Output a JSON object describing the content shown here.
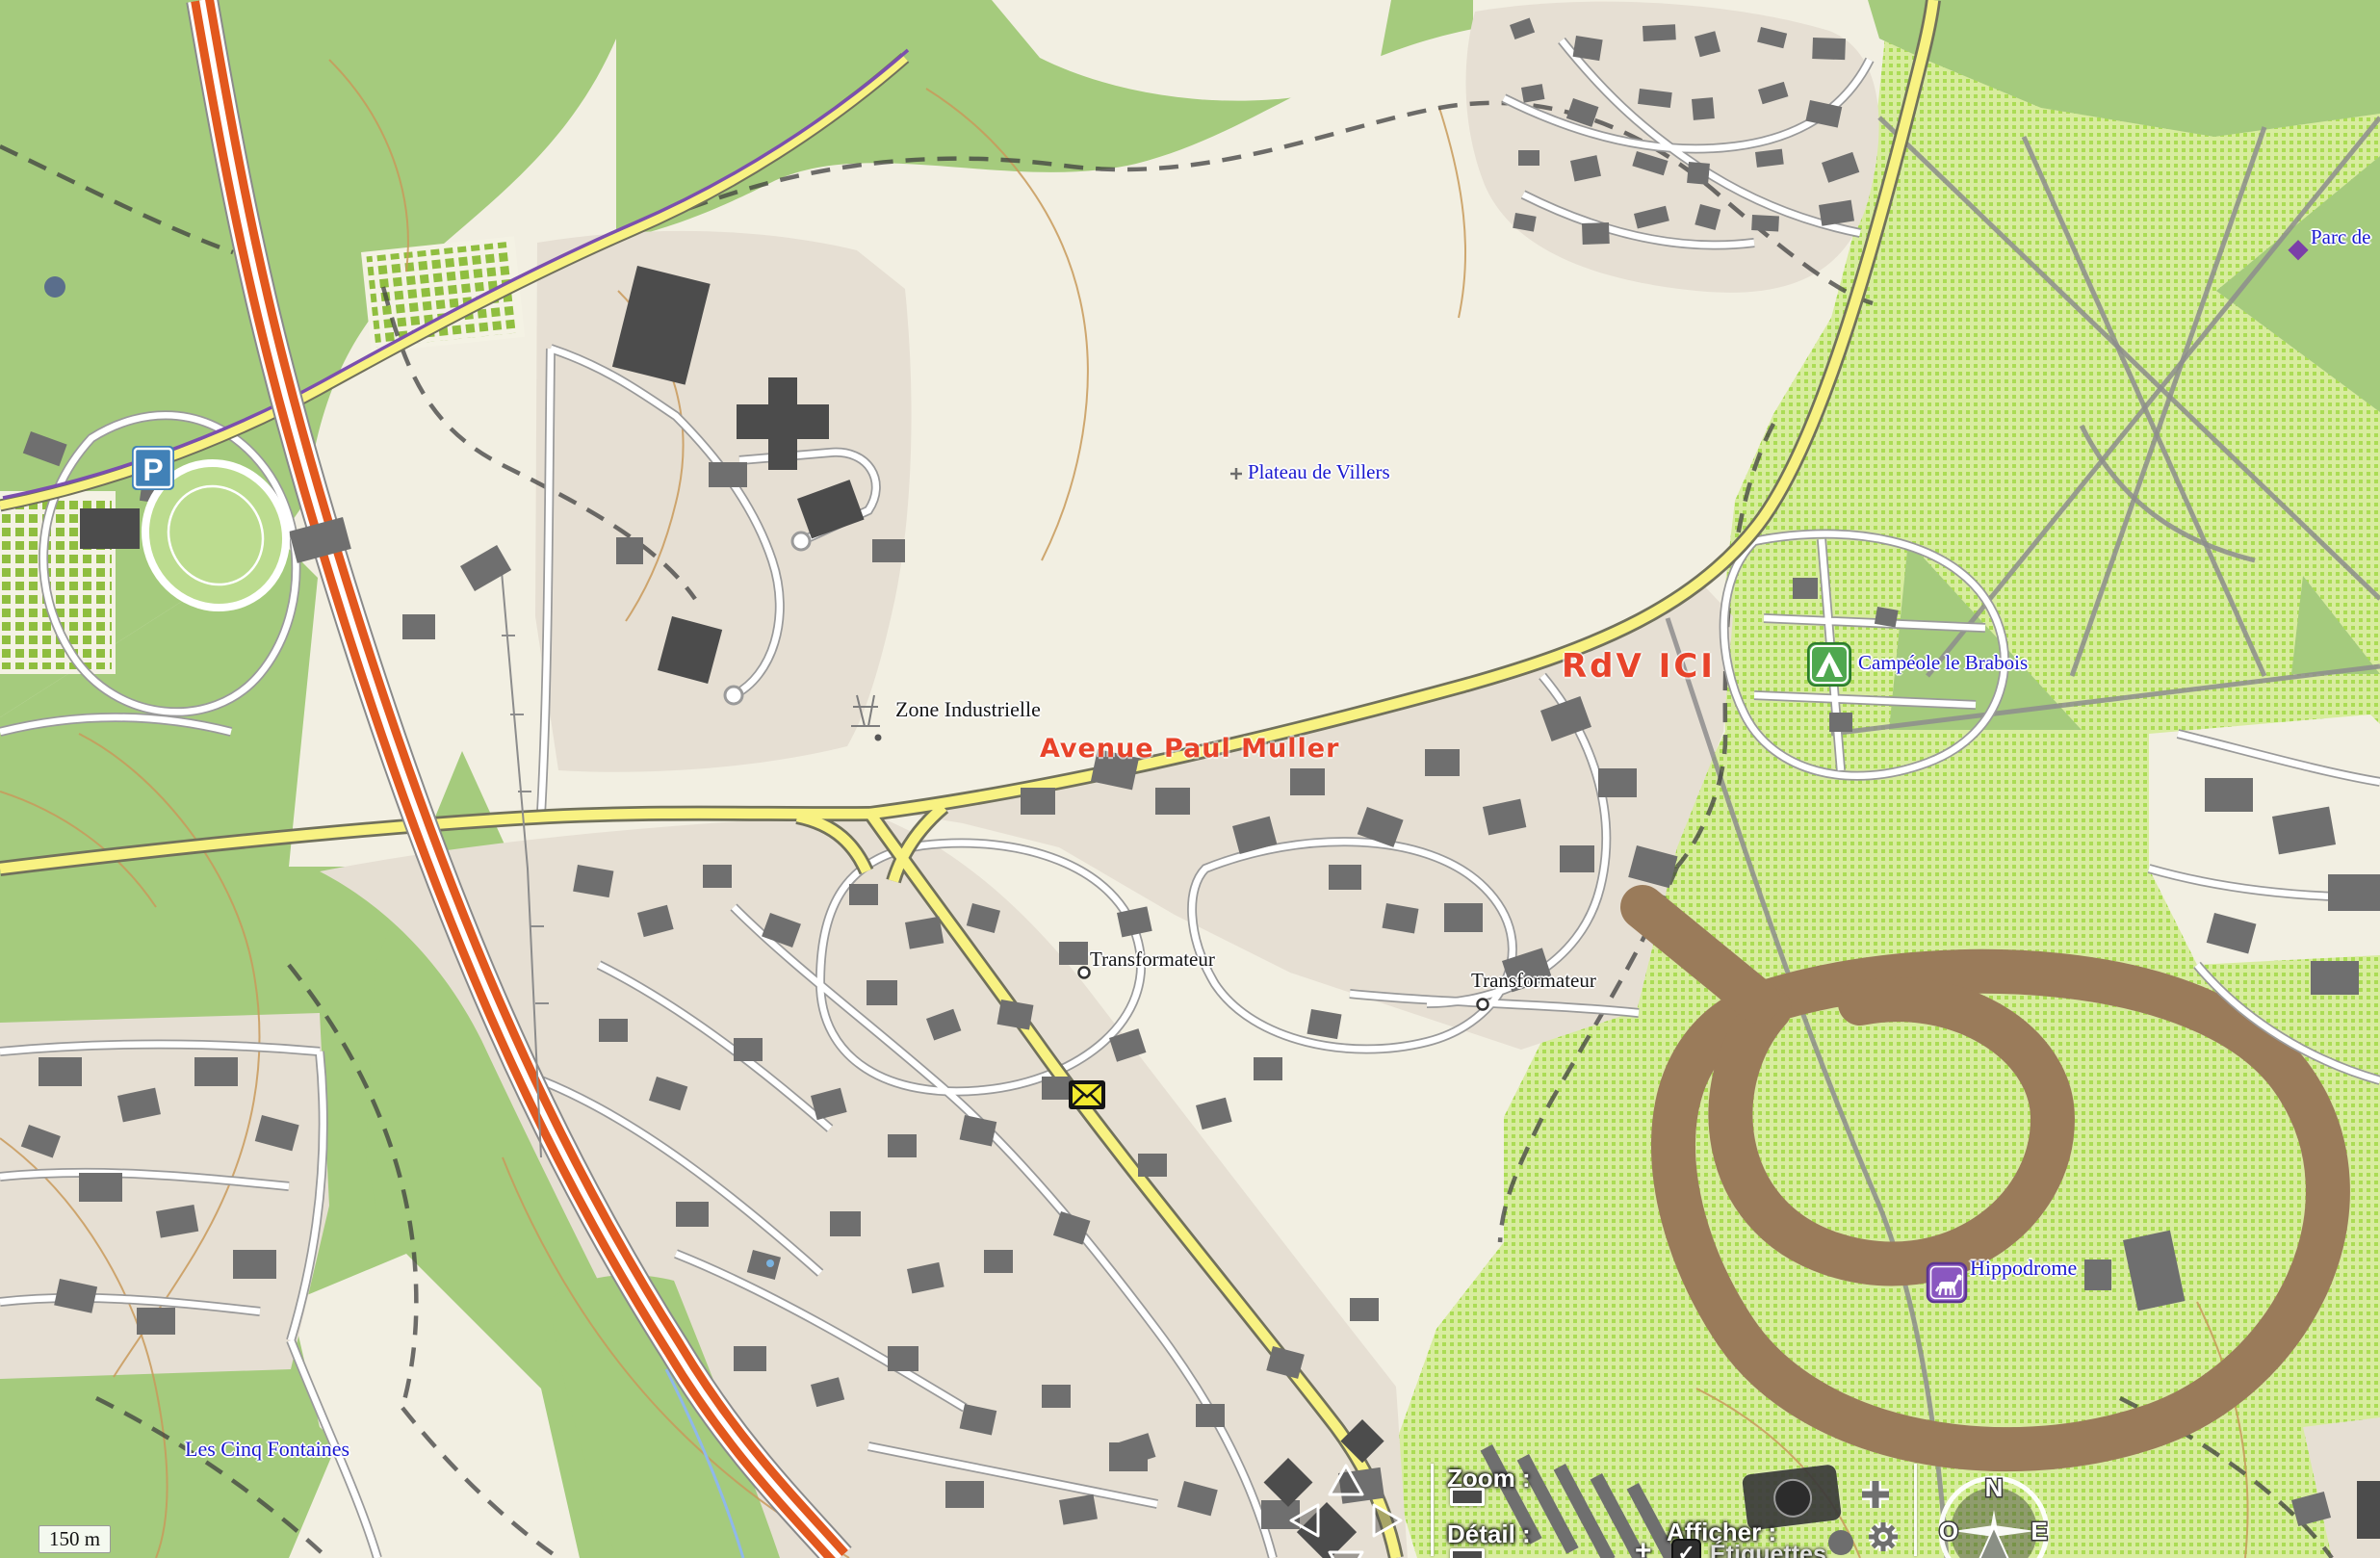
{
  "map": {
    "labels": {
      "plateau": "Plateau de Villers",
      "zone_industrielle": "Zone Industrielle",
      "transformateur_1": "Transformateur",
      "transformateur_2": "Transformateur",
      "campeole": "Campéole le Brabois",
      "hippodrome": "Hippodrome",
      "les_cinq_fontaines": "Les Cinq Fontaines",
      "parc_de": "Parc de",
      "parking": "P"
    },
    "annotations": {
      "rdv": "RdV ICI",
      "avenue": "Avenue Paul Muller"
    },
    "scale_bar": "150 m"
  },
  "controls": {
    "zoom_label": "Zoom :",
    "detail_label": "Détail :",
    "afficher_label": "Afficher :",
    "etiquettes_label": "Étiquettes",
    "compass": {
      "north": "N",
      "west": "O",
      "east": "E"
    }
  },
  "colors": {
    "cream": "#f2efe2",
    "forest": "#a5cb7d",
    "scrub": "#d8ec9f",
    "scrub-grid": "#abdc55",
    "urban": "#e6dfd3",
    "building": "#6f6f6f",
    "building-dark": "#4c4c4c",
    "road-casing": "#9a9a9a",
    "yellow-road": "#f8f282",
    "yellow-casing": "#71715c",
    "motorway": "#e2581e",
    "track-brown": "#9a7b5a",
    "path-gray": "#8d8d8d",
    "dash-dark": "#3f3f3f",
    "contour": "#c89a5a",
    "water": "#8fb8ea",
    "label-blue": "#1a18cf",
    "label-black": "#141414",
    "annotation-red": "#e8432a",
    "purple-path": "#7b4fae",
    "camping-green": "#4fa84f",
    "parking-blue": "#4181b7",
    "horse-purple": "#8a57c0"
  }
}
